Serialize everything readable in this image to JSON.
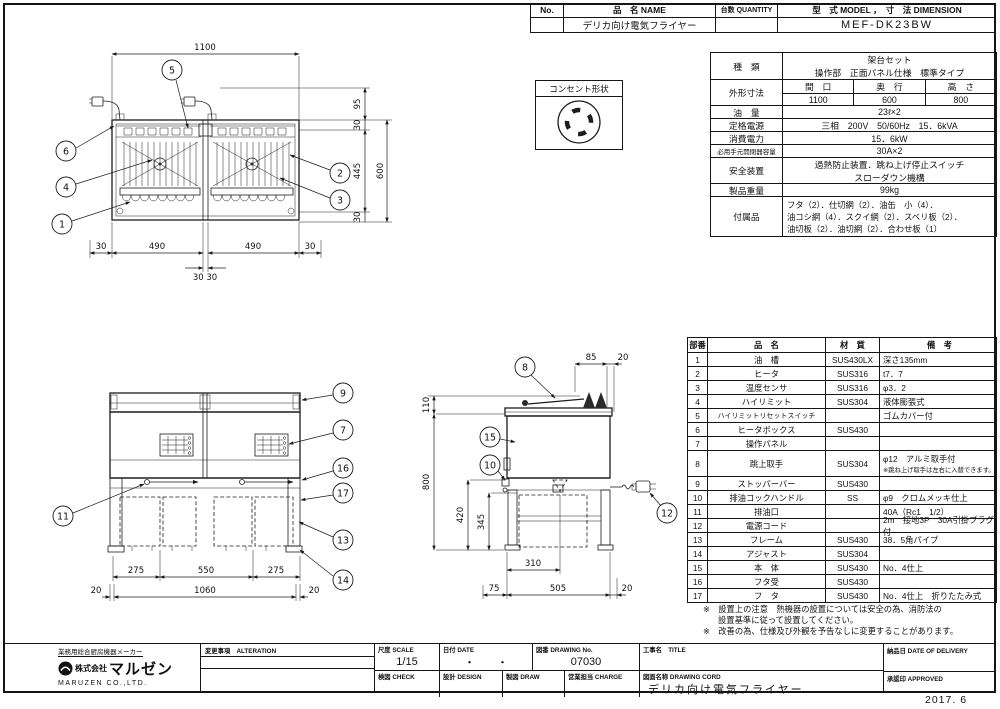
{
  "header": {
    "no_label": "No.",
    "name_label": "品　名 NAME",
    "qty_label": "台数 QUANTITY",
    "model_label": "型　式 MODEL ，　寸　法 DIMENSION",
    "product_name": "デリカ向け電気フライヤー",
    "qty_value": "",
    "model_value": "MEF-DK23BW"
  },
  "spec": {
    "kind_label": "種　類",
    "kind_line1": "架台セット",
    "kind_line2": "操作部　正面パネル仕様　標準タイプ",
    "dims_label": "外形寸法",
    "width_label": "間　口",
    "depth_label": "奥　行",
    "height_label": "高　さ",
    "width_value": "1100",
    "depth_value": "600",
    "height_value": "800",
    "oil_label": "油　量",
    "oil_value": "23ℓ×2",
    "power_label": "定格電源",
    "power_value": "三相　200V　50/60Hz　15．6kVA",
    "consumption_label": "消費電力",
    "consumption_value": "15．6kW",
    "breaker_label": "必用手元開閉器容量",
    "breaker_value": "30A×2",
    "safety_label": "安全装置",
    "safety_line1": "過熱防止装置．跳ね上げ停止スイッチ",
    "safety_line2": "スローダウン機構",
    "weight_label": "製品重量",
    "weight_value": "99kg",
    "acc_label": "付属品",
    "acc_line1": "フタ（2）．仕切網（2）．油缶　小（4）．",
    "acc_line2": "油コシ網（4）．スクイ網（2）．スベリ板（2）．",
    "acc_line3": "油切板（2）．油切網（2）．合わせ板（1）"
  },
  "outlet": {
    "label": "コンセント形状"
  },
  "parts": {
    "h_no": "部番",
    "h_name": "品　名",
    "h_mat": "材　質",
    "h_note": "備　考",
    "rows": [
      {
        "no": "1",
        "name": "油　槽",
        "mat": "SUS430LX",
        "note": "深さ135mm"
      },
      {
        "no": "2",
        "name": "ヒータ",
        "mat": "SUS316",
        "note": "t7．7"
      },
      {
        "no": "3",
        "name": "温度センサ",
        "mat": "SUS316",
        "note": "φ3．2"
      },
      {
        "no": "4",
        "name": "ハイリミット",
        "mat": "SUS304",
        "note": "液体膨張式"
      },
      {
        "no": "5",
        "name": "ハイリミットリセットスイッチ",
        "mat": "",
        "note": "ゴムカバー付"
      },
      {
        "no": "6",
        "name": "ヒータボックス",
        "mat": "SUS430",
        "note": ""
      },
      {
        "no": "7",
        "name": "操作パネル",
        "mat": "",
        "note": ""
      },
      {
        "no": "8",
        "name": "跳上取手",
        "mat": "SUS304",
        "note": "φ12　アルミ取手付",
        "note2": "※跳ね上げ取手は左右に入替できます。"
      },
      {
        "no": "9",
        "name": "ストッパーバー",
        "mat": "SUS430",
        "note": ""
      },
      {
        "no": "10",
        "name": "排油コックハンドル",
        "mat": "SS",
        "note": "φ9　クロムメッキ仕上"
      },
      {
        "no": "11",
        "name": "排油口",
        "mat": "",
        "note": "40A（Rc1　1/2）"
      },
      {
        "no": "12",
        "name": "電源コード",
        "mat": "",
        "note": "2m　接地3P　30A引掛プラグ付"
      },
      {
        "no": "13",
        "name": "フレーム",
        "mat": "SUS430",
        "note": "38．5角パイプ"
      },
      {
        "no": "14",
        "name": "アジャスト",
        "mat": "SUS304",
        "note": ""
      },
      {
        "no": "15",
        "name": "本　体",
        "mat": "SUS430",
        "note": "No．4仕上"
      },
      {
        "no": "16",
        "name": "フタ受",
        "mat": "SUS430",
        "note": ""
      },
      {
        "no": "17",
        "name": "フ　タ",
        "mat": "SUS430",
        "note": "No．4仕上　折りたたみ式"
      }
    ]
  },
  "notes": {
    "line1": "※　設置上の注意　熱機器の設置については安全の為、消防法の",
    "line2": "設置基準に従って設置してください。",
    "line3": "※　改善の為、仕様及び外観を予告なしに変更することがあります。"
  },
  "tblock": {
    "tagline": "業務用総合厨房機器メーカー",
    "company_prefix": "株式会社",
    "company_logo": "マルゼン",
    "company_en": "MARUZEN CO.,LTD.",
    "alteration": "変更事項　ALTERATION",
    "scale_label": "尺度 SCALE",
    "scale_value": "1/15",
    "date_label": "日付 DATE",
    "date_value": "・　　・",
    "dwgno_label": "図番 DRAWING No.",
    "dwgno_value": "07030",
    "title_label": "工事名　TITLE",
    "check_label": "検図 CHECK",
    "design_label": "設計 DESIGN",
    "draw_label": "製図 DRAW",
    "charge_label": "営業担当 CHARGE",
    "dwgname_label": "図面名称 DRAWING CORD",
    "dwgname_value": "デリカ向け電気フライヤー",
    "delivery_label": "納品日 DATE OF DELIVERY",
    "approved_label": "承認印 APPROVED",
    "issue_date": "2017. 6"
  },
  "plan": {
    "dim_width": "1100",
    "right_chain": [
      "95",
      "30",
      "445",
      "30"
    ],
    "right_total": "600",
    "bottom_row1": [
      "30",
      "490",
      "490",
      "30"
    ],
    "bottom_row2": "30 30",
    "balloons": [
      "5",
      "6",
      "4",
      "1",
      "2",
      "3"
    ]
  },
  "front": {
    "row1": [
      "275",
      "550",
      "275"
    ],
    "row2": [
      "20",
      "1060",
      "20"
    ],
    "balloons": [
      "9",
      "7",
      "16",
      "17",
      "13",
      "14",
      "11"
    ]
  },
  "side": {
    "top": [
      "85",
      "20"
    ],
    "left": [
      "110",
      "800"
    ],
    "inner": [
      "420",
      "345"
    ],
    "middle": "310",
    "bottom": [
      "75",
      "505",
      "20"
    ],
    "balloons": [
      "8",
      "15",
      "10",
      "12"
    ]
  }
}
